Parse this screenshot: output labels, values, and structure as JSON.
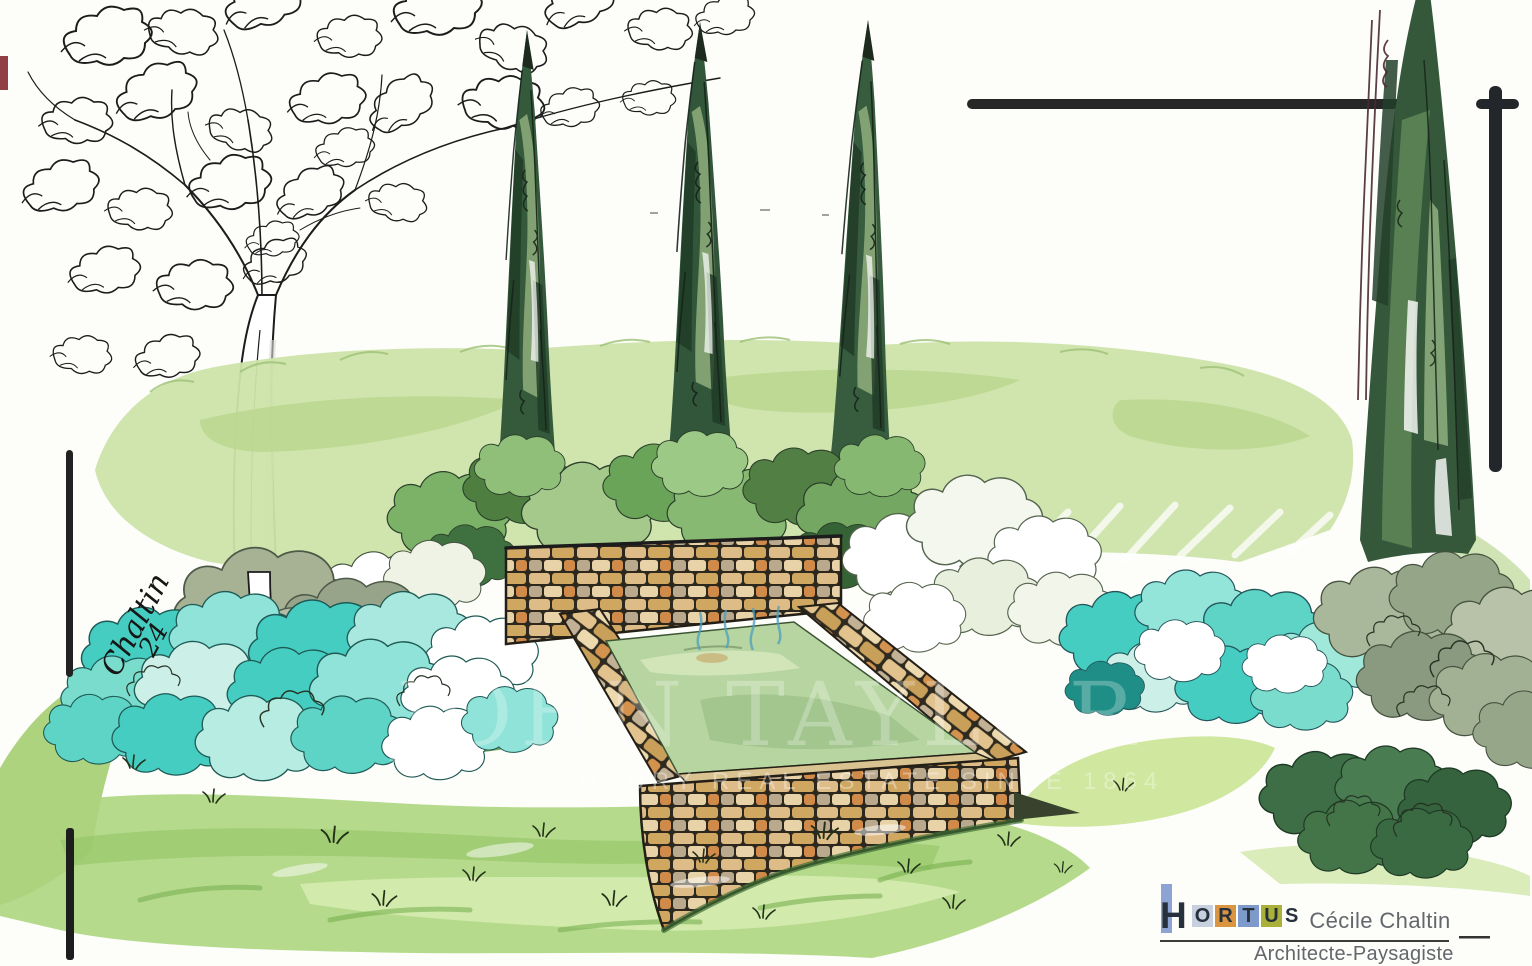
{
  "artwork": {
    "signature": {
      "name": "Chaltin",
      "year": "24"
    }
  },
  "watermark": {
    "title": "JOHN TAYLOR",
    "tagline": "LUXURY REAL ESTATE SINCE 1864"
  },
  "logo": {
    "brand_letters": [
      "H",
      "O",
      "R",
      "T",
      "U",
      "S"
    ],
    "name": "Cécile Chaltin",
    "title": "Architecte-Paysagiste",
    "colors": {
      "h_bar": "#8CA3D4",
      "o_square": "#c7d0de",
      "r_square": "#d9953f",
      "t_square": "#7e9aca",
      "u_square": "#a9b138",
      "letter": "#27313c",
      "text": "#63676c"
    }
  },
  "palette": {
    "ink": "#1c1c1c",
    "cypress_dark": "#2c4a31",
    "turquoise": "#45cdc1",
    "stone_tan": "#ddbb84",
    "grass_green": "#b5da8c",
    "pool_water": "#b7d5a0"
  }
}
